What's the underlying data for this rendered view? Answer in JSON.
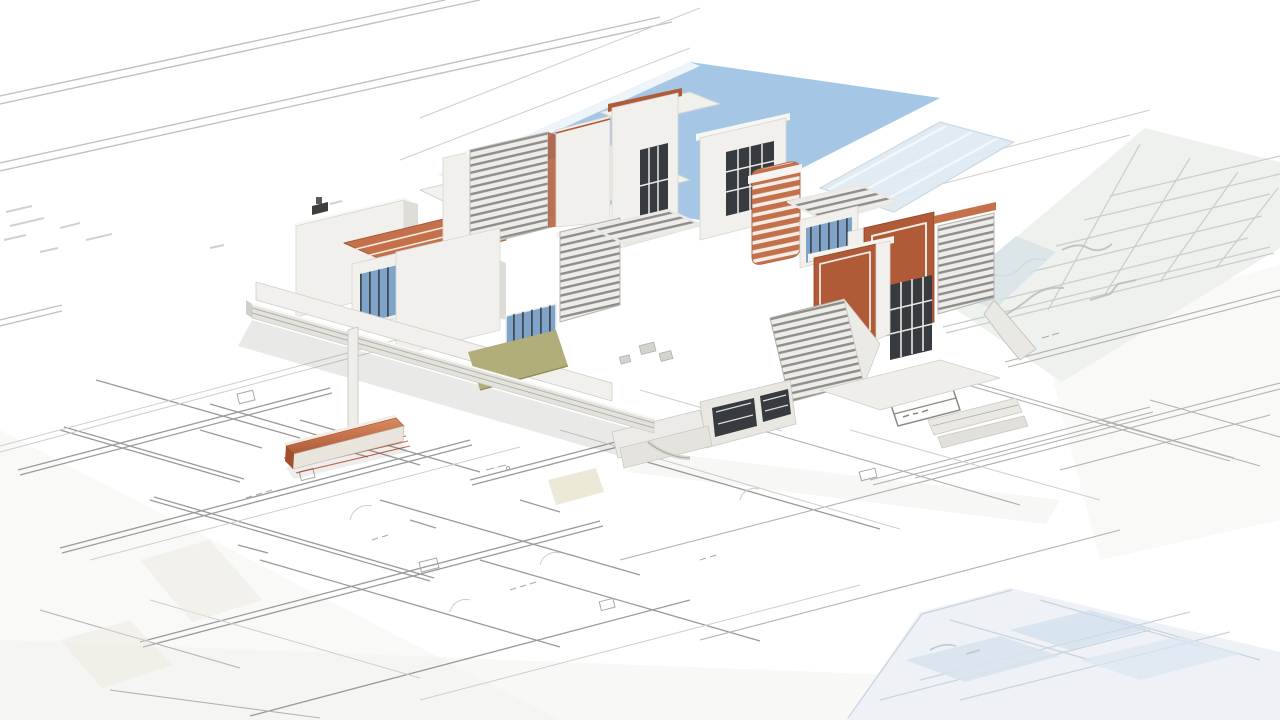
{
  "scene": {
    "type": "3d-architectural-render",
    "description": "Photorealistic 3D cutaway model of a modern two-storey house with terracotta accent walls, louvered roofs and a blue pool, standing on large architectural blueprint sheets with floor-plan line work. A loose terracotta wall element lies on the blueprint in the left foreground with red leader lines. Faint secondary plan sheets appear top-left, top-right (greenish site plan with grid) and bottom-right (bluish floor plan). All dimension/annotation text on the blueprints is too small to be legible.",
    "legible_text": []
  },
  "colors": {
    "background": "#ffffff",
    "wash_gray": "#efeeec",
    "sheet_line": "#c2c1bf",
    "plan_line_dark": "#9a9a98",
    "plan_line_mid": "#b4b3b0",
    "plan_line_light": "#cfcecb",
    "pool_blue": "#9dc2e3",
    "glass_canopy": "#dde9f3",
    "siteplan_tint": "#ecefeb",
    "siteplan_line": "#c6cfc8",
    "siteplan_scribble": "#b2c0b4",
    "corner_plan_tint": "#eef2f6",
    "corner_plan_line": "#c8d3de",
    "corner_plan_room": "#d7e3ef",
    "wall_white": "#f1f0ec",
    "wall_bright": "#f8f8f5",
    "wall_shade": "#dddcd6",
    "wall_dark": "#c7c6c0",
    "edge_gray": "#cfcec9",
    "louver_light": "#edece8",
    "louver_dark": "#8e8d89",
    "terracotta": "#b05a38",
    "terracotta_dark": "#a14e2e",
    "terracotta_light": "#c4714b",
    "window_frame": "#373a3e",
    "mullion_white": "#e9e9e6",
    "glass_blue": "#7fa3c9",
    "patio_olive": "#b1ae7a",
    "leader_red": "#c24a28",
    "beam_face": "#e9e5dc",
    "shadow": "#55544f"
  }
}
